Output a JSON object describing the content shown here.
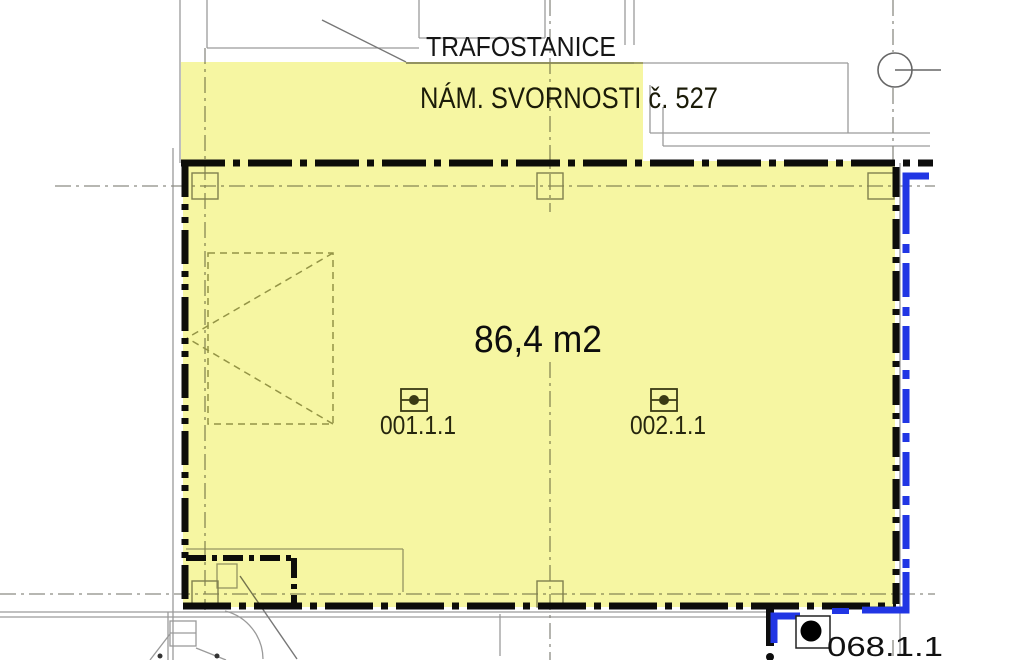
{
  "plan": {
    "title": "TRAFOSTANICE",
    "address": "NÁM. SVORNOSTI č. 527",
    "area_label": "86,4 m2",
    "rooms": [
      {
        "id": "001.1.1"
      },
      {
        "id": "002.1.1"
      },
      {
        "id": "068.1.1"
      }
    ],
    "colors": {
      "highlight_yellow": "#f6f6a2",
      "boundary_black": "#0d0d0d",
      "lease_line_blue": "#2136e4",
      "grid_gray": "#8c8c84",
      "context_gray": "#9a9a9a"
    }
  }
}
